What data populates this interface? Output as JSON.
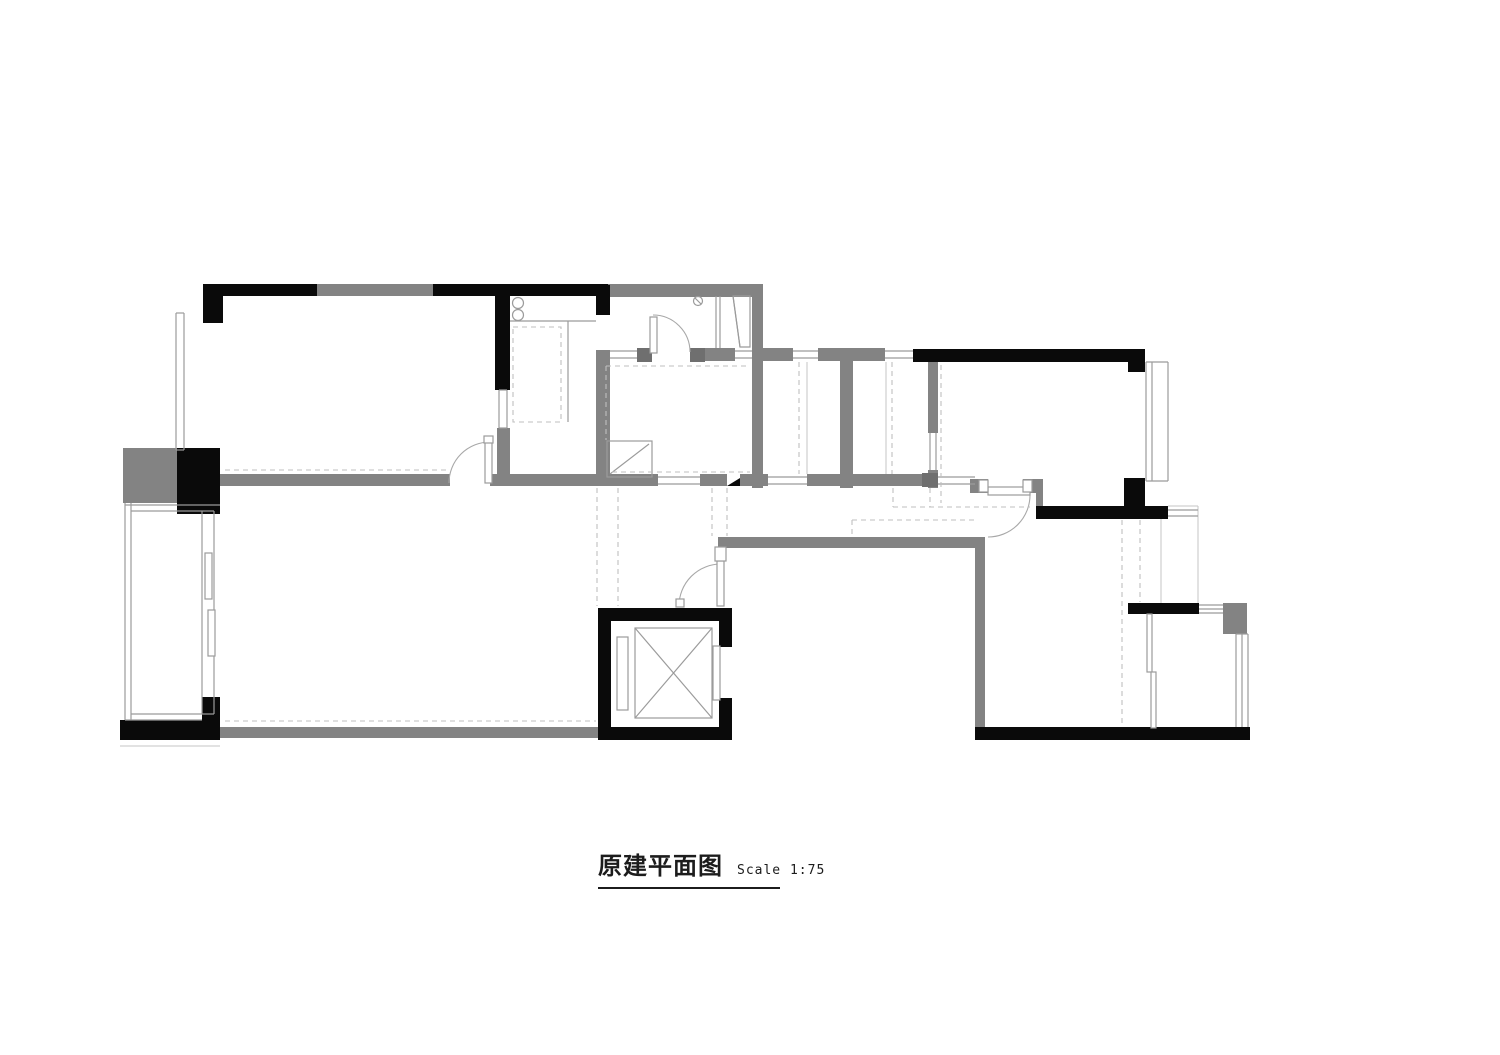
{
  "caption": {
    "title": "原建平面图",
    "scale": "Scale 1:75"
  },
  "colors": {
    "background": "#ffffff",
    "wall_black": "#0a0a0a",
    "wall_gray": "#838383",
    "wall_gray_dark": "#6f6f6f",
    "outline": "#9b9b9b",
    "outline_light": "#c6c6c6",
    "dashed": "#bfbfbf",
    "text": "#1c1c1c"
  },
  "drawing": {
    "type": "architectural-floor-plan"
  }
}
